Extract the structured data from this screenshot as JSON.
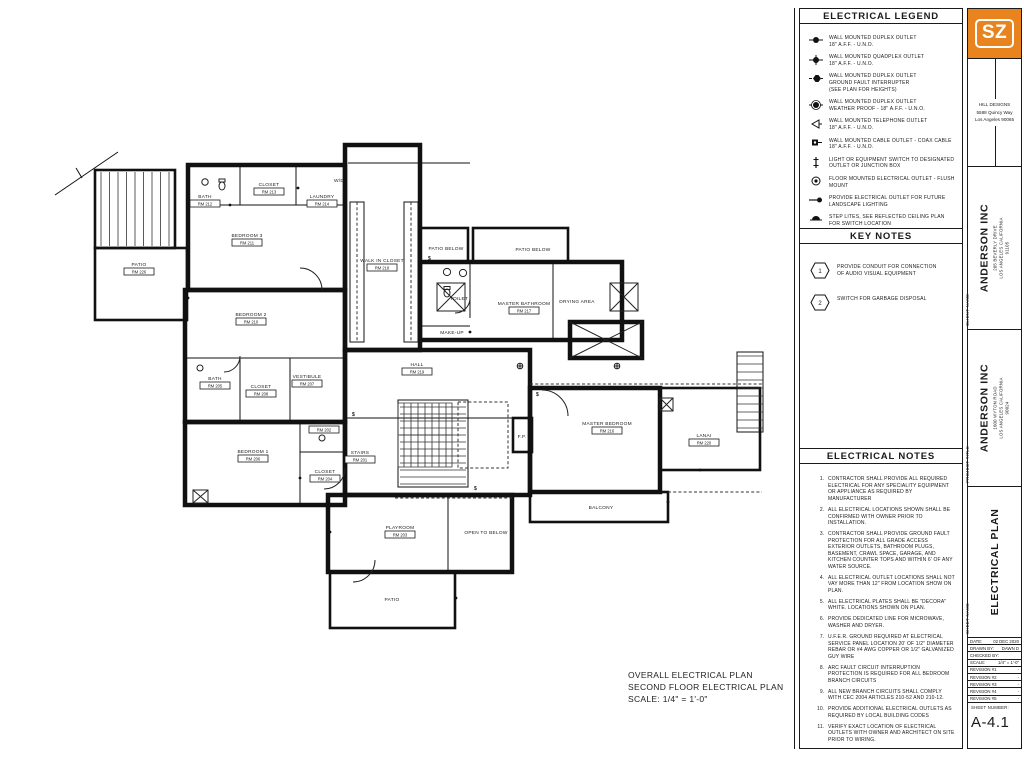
{
  "sheet": {
    "caption": {
      "line1": "OVERALL ELECTRICAL PLAN",
      "line2": "SECOND FLOOR ELECTRICAL PLAN",
      "line3": "SCALE: 1/4\" = 1'-0\""
    }
  },
  "legend": {
    "title": "ELECTRICAL LEGEND",
    "items": [
      {
        "symbol": "duplex-outlet",
        "lines": [
          "WALL MOUNTED DUPLEX OUTLET",
          "18\" A.F.F. - U.N.O."
        ]
      },
      {
        "symbol": "quadplex-outlet",
        "lines": [
          "WALL MOUNTED QUADPLEX OUTLET",
          "18\" A.F.F. - U.N.O."
        ]
      },
      {
        "symbol": "gfi-outlet",
        "lines": [
          "WALL MOUNTED DUPLEX OUTLET",
          "GROUND FAULT INTERRUPTER",
          "(SEE PLAN FOR HEIGHTS)"
        ]
      },
      {
        "symbol": "weatherproof-outlet",
        "lines": [
          "WALL MOUNTED DUPLEX OUTLET",
          "WEATHER PROOF - 18\" A.F.F. - U.N.O."
        ]
      },
      {
        "symbol": "telephone-outlet",
        "lines": [
          "WALL MOUNTED TELEPHONE OUTLET",
          "18\" A.F.F. - U.N.O."
        ]
      },
      {
        "symbol": "cable-outlet",
        "lines": [
          "WALL MOUNTED CABLE OUTLET - COAX CABLE",
          "18\" A.F.F. - U.N.O."
        ]
      },
      {
        "symbol": "switch",
        "lines": [
          "LIGHT OR EQUIPMENT SWITCH TO DESIGNATED",
          "OUTLET OR JUNCTION BOX"
        ]
      },
      {
        "symbol": "floor-outlet",
        "lines": [
          "FLOOR MOUNTED ELECTRICAL OUTLET - FLUSH",
          "MOUNT"
        ]
      },
      {
        "symbol": "landscape-outlet",
        "lines": [
          "PROVIDE ELECTRICAL OUTLET FOR FUTURE",
          "LANDSCAPE LIGHTING"
        ]
      },
      {
        "symbol": "step-lite",
        "lines": [
          "STEP LITES, SEE REFLECTED CEILING PLAN",
          "FOR SWITCH LOCATION"
        ]
      }
    ]
  },
  "key_notes": {
    "title": "KEY NOTES",
    "items": [
      {
        "num": "1",
        "text": "PROVIDE CONDUIT FOR CONNECTION OF AUDIO VISUAL EQUIPMENT"
      },
      {
        "num": "2",
        "text": "SWITCH FOR GARBAGE DISPOSAL"
      }
    ]
  },
  "electrical_notes": {
    "title": "ELECTRICAL NOTES",
    "items": [
      {
        "num": "1.",
        "text": "CONTRACTOR SHALL PROVIDE ALL REQUIRED ELECTRICAL FOR ANY SPECIALITY EQUIPMENT OR APPLIANCE AS REQUIRED BY MANUFACTURER"
      },
      {
        "num": "2.",
        "text": "ALL ELECTRICAL LOCATIONS SHOWN SHALL BE CONFIRMED WITH OWNER PRIOR TO INSTALLATION."
      },
      {
        "num": "3.",
        "text": "CONTRACTOR SHALL PROVIDE GROUND FAULT PROTECTION FOR ALL GRADE ACCESS EXTERIOR OUTLETS, BATHROOM PLUGS, BASEMENT, CRAWL SPACE, GARAGE, AND KITCHEN COUNTER TOPS AND WITHIN 6' OF ANY WATER SOURCE."
      },
      {
        "num": "4.",
        "text": "ALL ELECTRICAL OUTLET LOCATIONS SHALL NOT VAY MORE THAN 12\" FROM LOCATION SHOW ON PLAN."
      },
      {
        "num": "5.",
        "text": "ALL ELECTRICAL PLATES SHALL BE \"DECORA\" WHITE. LOCATIONS SHOWN ON PLAN."
      },
      {
        "num": "6.",
        "text": "PROVIDE DEDICATED LINE FOR MICROWAVE, WASHER AND DRYER."
      },
      {
        "num": "7.",
        "text": "U.F.E.R. GROUND REQUIRED AT ELECTRICAL SERVICE PANEL LOCATION 20' OF 1/2\" DIAMETER REBAR OR #4 AWG COPPER OR 1/2\" GALVANIZED GUY WIRE"
      },
      {
        "num": "8.",
        "text": "ARC FAULT CIRCUIT INTERRUPTION PROTECTION IS REQUIRED FOR ALL BEDROOM BRANCH CIRCUITS"
      },
      {
        "num": "9.",
        "text": "ALL NEW BRANCH CIRCUITS SHALL COMPLY WITH CEC 2004 ARTICLES 210-52 AND 210-12."
      },
      {
        "num": "10.",
        "text": "PROVIDE ADDITIONAL ELECTRICAL OUTLETS AS REQUIRED BY LOCAL BUILDING CODES"
      },
      {
        "num": "11.",
        "text": "VERIFY EXACT LOCATION OF ELECTRICAL OUTLETS WITH OWNER AND ARCHITECT ON SITE PRIOR TO WIRING."
      }
    ]
  },
  "title_block": {
    "logo_text": "SZ",
    "logo_color": "#e8831d",
    "designer": {
      "name": "HILL DESIGNS",
      "line1": "5588 Quincy Way",
      "line2": "Los Angeles 90065"
    },
    "client": {
      "label": "CLIENT NAME",
      "name": "ANDERSON INC",
      "addr1": "205 BEVERLY DRIVE",
      "addr2": "LOS ANGELES CALIFORNIA",
      "addr3": "91105"
    },
    "project": {
      "label": "PROJECT TITLE",
      "name": "ANDERSON INC",
      "addr1": "1600 WYTON ROAD",
      "addr2": "LOS ANGELES CALIFORNIA",
      "addr3": "90024"
    },
    "sheet_name": {
      "label": "SHEET NAME",
      "name": "ELECTRICAL PLAN"
    },
    "info_rows": [
      {
        "label": "DATE:",
        "value": "02 DEC 2020"
      },
      {
        "label": "DRAWN BY:",
        "value": "DAWN D"
      },
      {
        "label": "CHECKED BY:",
        "value": ""
      },
      {
        "label": "SCALE:",
        "value": "1/4\" = 1'-0\""
      },
      {
        "label": "REVISION #1",
        "value": "-"
      },
      {
        "label": "REVISION #2",
        "value": "-"
      },
      {
        "label": "REVISION #3",
        "value": "-"
      },
      {
        "label": "REVISION #4",
        "value": "-"
      },
      {
        "label": "REVISION #5",
        "value": "-"
      }
    ],
    "sheet_number_label": "SHEET NUMBER:",
    "sheet_number": "A-4.1"
  },
  "plan": {
    "rooms": [
      {
        "name": "PATIO",
        "tag": "RM 226"
      },
      {
        "name": "BEDROOM 3",
        "tag": "RM 211"
      },
      {
        "name": "BATH",
        "tag": "RM 212"
      },
      {
        "name": "CLOSET",
        "tag": "RM 213"
      },
      {
        "name": "LAUNDRY",
        "tag": "RM 214"
      },
      {
        "name": "BEDROOM 2",
        "tag": "RM 210"
      },
      {
        "name": "WALK IN CLOSET",
        "tag": "RM 218"
      },
      {
        "name": "PATIO BELOW"
      },
      {
        "name": "PATIO BELOW"
      },
      {
        "name": "TOILET"
      },
      {
        "name": "MASTER BATHROOM",
        "tag": "RM 217"
      },
      {
        "name": "DRYING AREA"
      },
      {
        "name": "MAKE-UP"
      },
      {
        "name": "HALL",
        "tag": "RM 219"
      },
      {
        "name": "VESTIBULE",
        "tag": "RM 207"
      },
      {
        "name": "BATH",
        "tag": "RM 205"
      },
      {
        "name": "CLOSET",
        "tag": "RM 208"
      },
      {
        "name": "BEDROOM 1",
        "tag": "RM 206"
      },
      {
        "name": "BATH",
        "tag": "RM 202"
      },
      {
        "name": "STAIRS",
        "tag": "RM 201"
      },
      {
        "name": "CLOSET",
        "tag": "RM 204"
      },
      {
        "name": "MASTER BEDROOM",
        "tag": "RM 216"
      },
      {
        "name": "LANAI",
        "tag": "RM 220"
      },
      {
        "name": "BALCONY"
      },
      {
        "name": "PLAYROOM",
        "tag": "RM 203"
      },
      {
        "name": "OPEN TO BELOW"
      },
      {
        "name": "PATIO"
      },
      {
        "name": "F.P."
      },
      {
        "name": "W/D"
      }
    ]
  }
}
